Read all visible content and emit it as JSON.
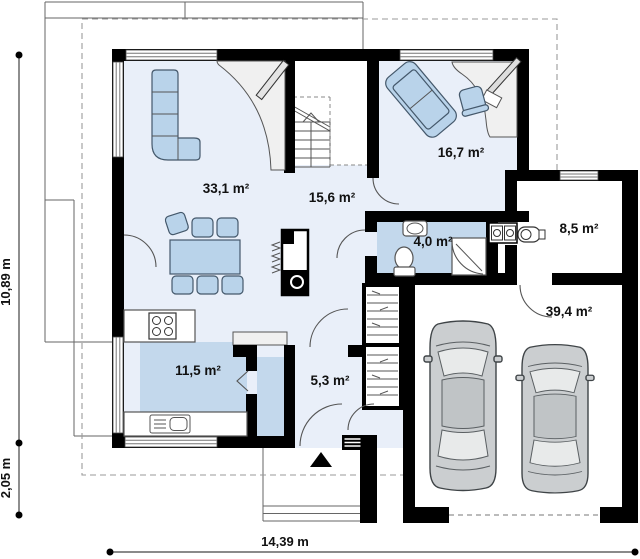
{
  "plan": {
    "rooms": [
      {
        "name": "living-room",
        "area_label": "33,1 m²"
      },
      {
        "name": "hallway",
        "area_label": "15,6 m²"
      },
      {
        "name": "office",
        "area_label": "16,7 m²"
      },
      {
        "name": "bathroom",
        "area_label": "4,0 m²"
      },
      {
        "name": "utility-room",
        "area_label": "8,5 m²"
      },
      {
        "name": "kitchen",
        "area_label": "11,5 m²"
      },
      {
        "name": "entry-hall",
        "area_label": "5,3 m²"
      },
      {
        "name": "garage",
        "area_label": "39,4 m²"
      }
    ],
    "dimensions": [
      {
        "name": "total-height",
        "label": "10,89 m"
      },
      {
        "name": "porch-depth",
        "label": "2,05 m"
      },
      {
        "name": "total-width",
        "label": "14,39 m"
      }
    ],
    "symbols": [
      "corner-sofa",
      "dining-table",
      "dining-chair",
      "fireplace",
      "staircase",
      "kitchen-stove",
      "kitchen-sink",
      "washbasin",
      "toilet",
      "shower-cabin",
      "washer-dryer",
      "boiler",
      "wardrobe-shelves",
      "office-desk",
      "office-chair",
      "office-sofa",
      "tv-panel",
      "car",
      "entrance-arrow",
      "doormat"
    ],
    "colors": {
      "wall": "#000000",
      "floor": "#e9eff9",
      "wet_floor": "#c3d8ec",
      "furniture": "#b9d3ea",
      "counter": "#f0f0f0",
      "car_body": "#cbced0",
      "dashed_outline": "#9a9a9a"
    }
  }
}
